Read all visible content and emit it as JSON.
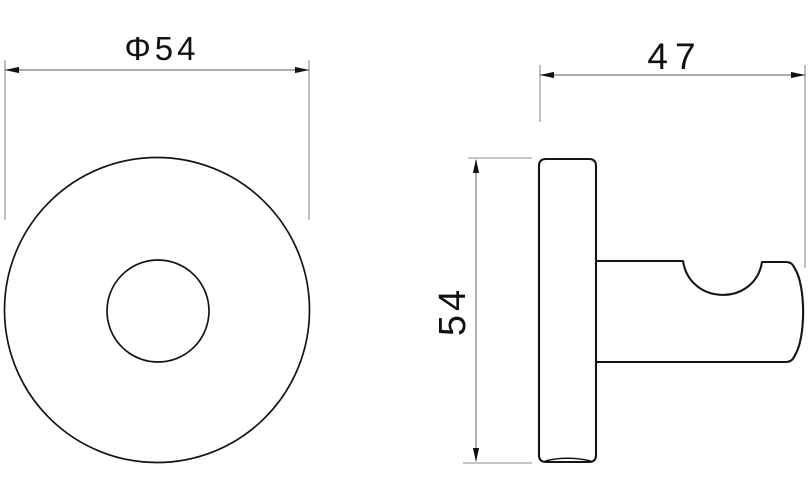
{
  "drawing": {
    "type": "technical-dimension-drawing",
    "background_color": "#ffffff",
    "object_line_color": "#141414",
    "dimension_line_color": "#7a7a7a",
    "text_color": "#111111",
    "front_view": {
      "diameter_label": "Φ54",
      "diameter_value": 54
    },
    "side_view": {
      "height_label": "54",
      "height_value": 54,
      "depth_label": "47",
      "depth_value": 47
    }
  }
}
